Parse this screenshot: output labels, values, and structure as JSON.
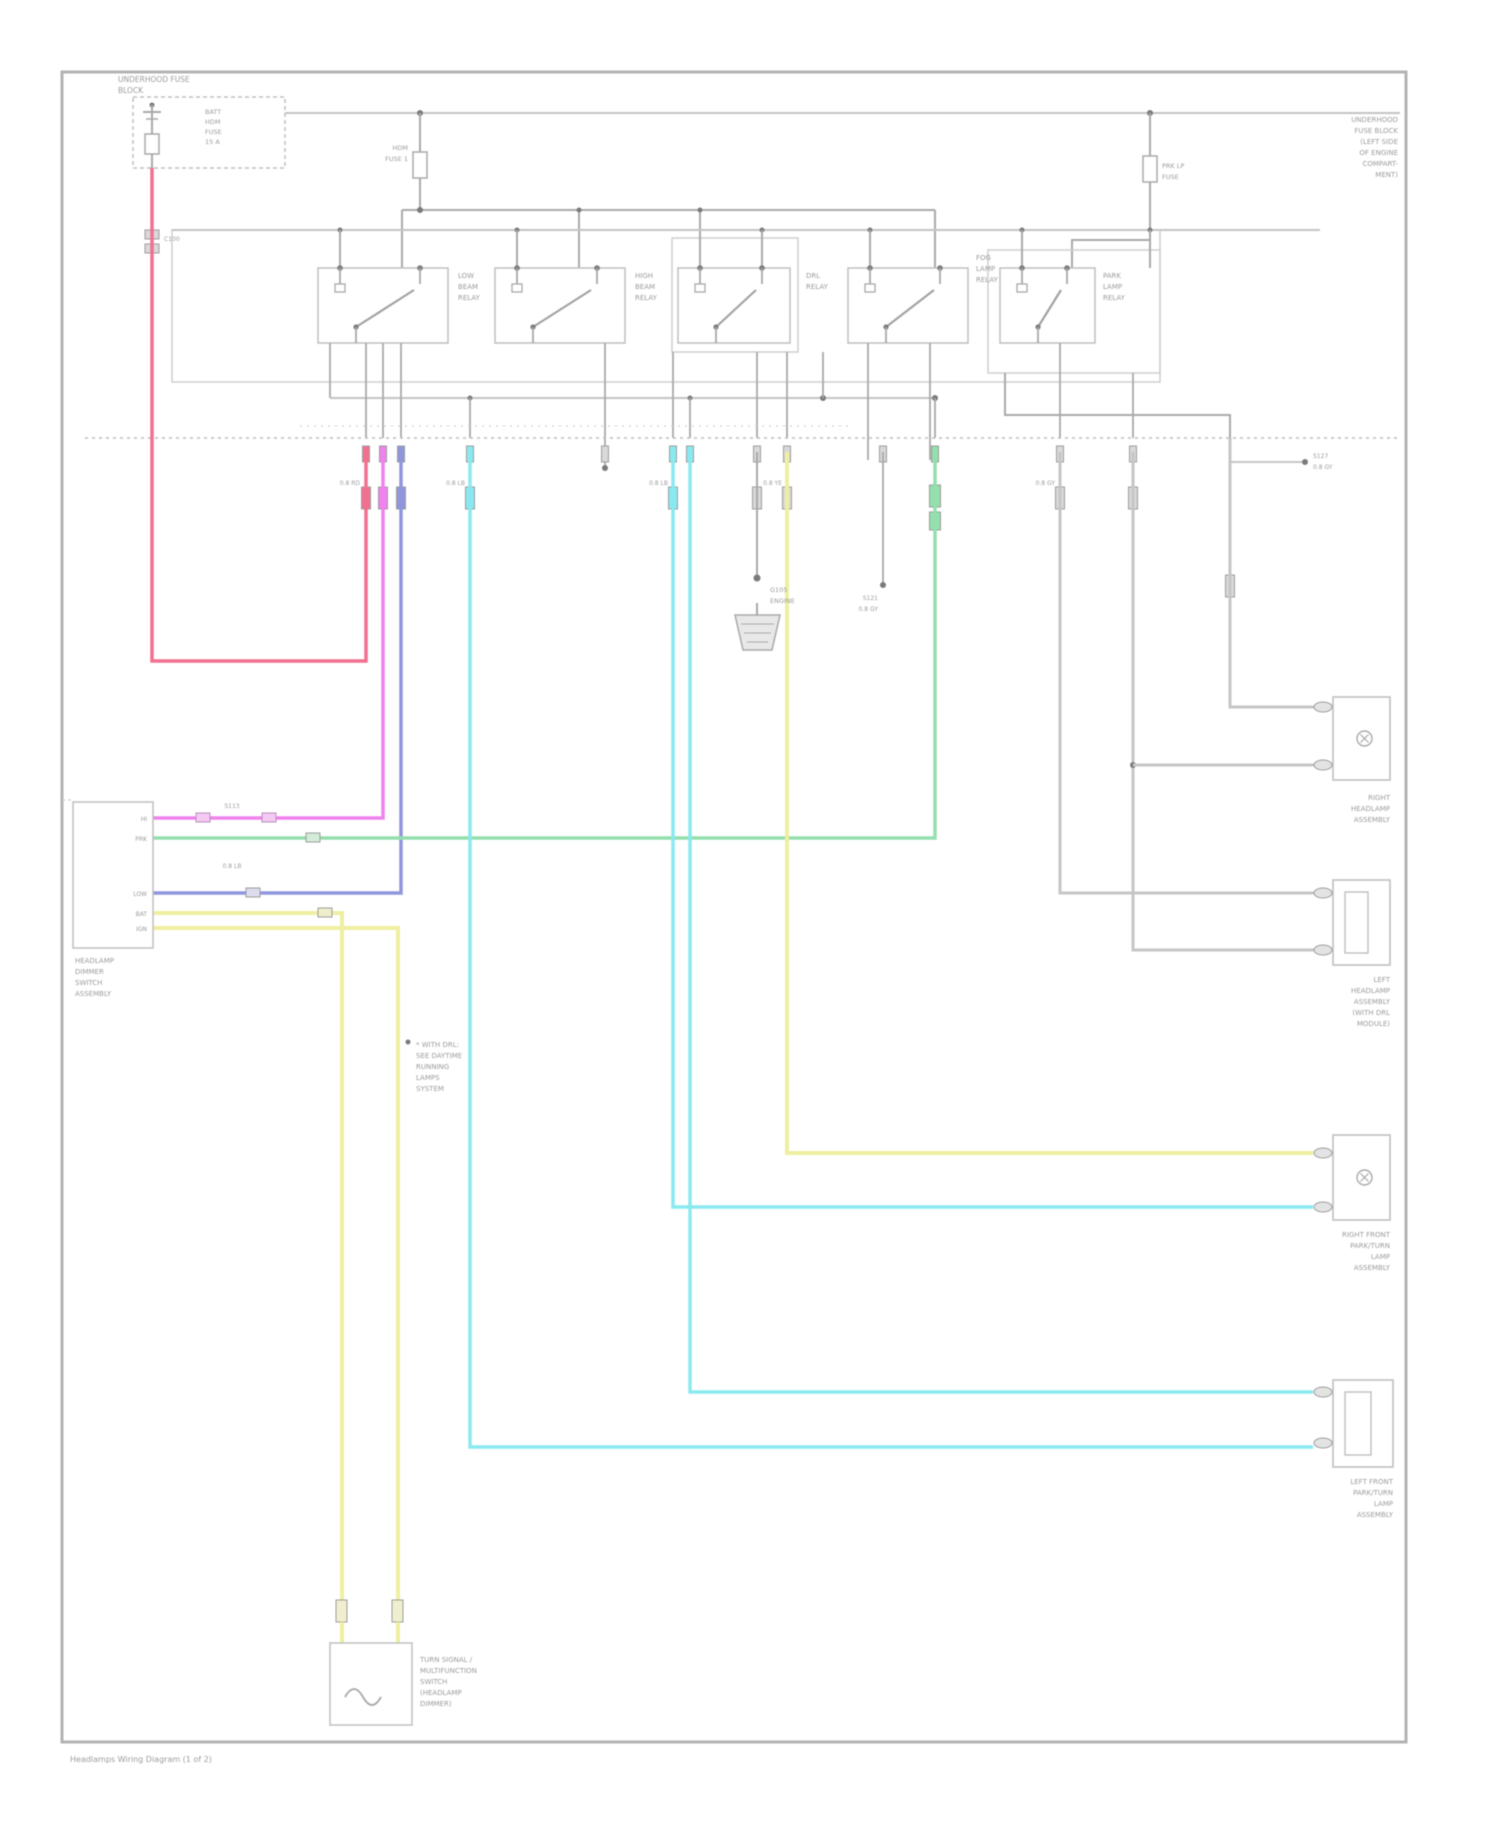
{
  "palette": {
    "red": "#f2708f",
    "magenta": "#ef82ee",
    "blue": "#9096dc",
    "cyan": "#8ae9f0",
    "green": "#93dfad",
    "yellow": "#efefa2",
    "gray_wire": "#c6c6c6",
    "line": "#a9a9a9",
    "faint": "#cfcfcf",
    "dot": "#7a7a7a",
    "text": "#9b9b9b",
    "border": "#b3b3b3",
    "box": "#bfbfbf"
  },
  "page": {
    "footer": "Headlamps Wiring Diagram (1 of 2)"
  },
  "fuse_block": {
    "title": [
      "UNDERHOOD FUSE",
      "BLOCK"
    ],
    "side_lines": [
      "BATT",
      "HDM",
      "FUSE",
      "15 A"
    ],
    "connector": "C100"
  },
  "fuses": {
    "left": {
      "label": [
        "HDM",
        "FUSE 1"
      ]
    },
    "right": {
      "label": [
        "PRK LP",
        "FUSE"
      ]
    }
  },
  "right_edge_note": [
    "UNDERHOOD",
    "FUSE BLOCK",
    "(LEFT SIDE",
    "OF ENGINE",
    "COMPART-",
    "MENT)"
  ],
  "relays": [
    {
      "lines": [
        "LOW",
        "BEAM",
        "RELAY"
      ]
    },
    {
      "lines": [
        "HIGH",
        "BEAM",
        "RELAY"
      ]
    },
    {
      "lines": [
        "DRL",
        "RELAY",
        ""
      ]
    },
    {
      "lines": [
        "FOG",
        "LAMP",
        "RELAY"
      ]
    },
    {
      "lines": [
        "PARK",
        "LAMP",
        "RELAY"
      ]
    }
  ],
  "ground": {
    "label": [
      "G105",
      "ENGINE"
    ]
  },
  "splices": {
    "s1": "S121",
    "s2": "S127",
    "s3": "S113",
    "s4": "S128"
  },
  "left_module": {
    "pins": [
      "HI",
      "PRK",
      "LOW",
      "BAT",
      "IGN"
    ],
    "label": [
      "HEADLAMP",
      "DIMMER",
      "SWITCH",
      "ASSEMBLY"
    ]
  },
  "note": [
    "* WITH DRL:",
    "SEE DAYTIME",
    "RUNNING",
    "LAMPS",
    "SYSTEM"
  ],
  "bottom_box": {
    "label": [
      "TURN SIGNAL /",
      "MULTIFUNCTION",
      "SWITCH",
      "(HEADLAMP",
      "DIMMER)"
    ]
  },
  "right_boxes": [
    {
      "label": [
        "RIGHT",
        "HEADLAMP",
        "ASSEMBLY",
        ""
      ]
    },
    {
      "label": [
        "LEFT",
        "HEADLAMP",
        "ASSEMBLY",
        "(WITH DRL",
        "MODULE)",
        ""
      ]
    },
    {
      "label": [
        "RIGHT FRONT",
        "PARK/TURN",
        "LAMP",
        "ASSEMBLY"
      ]
    },
    {
      "label": [
        "LEFT FRONT",
        "PARK/TURN",
        "LAMP",
        "ASSEMBLY",
        "",
        ""
      ]
    }
  ],
  "micro": {
    "w1": "0.8 RD",
    "w2": "0.8 PK",
    "w3": "0.8 DB",
    "w4": "0.8 LB",
    "w5": "0.8 YE",
    "w6": "0.8 GY"
  }
}
